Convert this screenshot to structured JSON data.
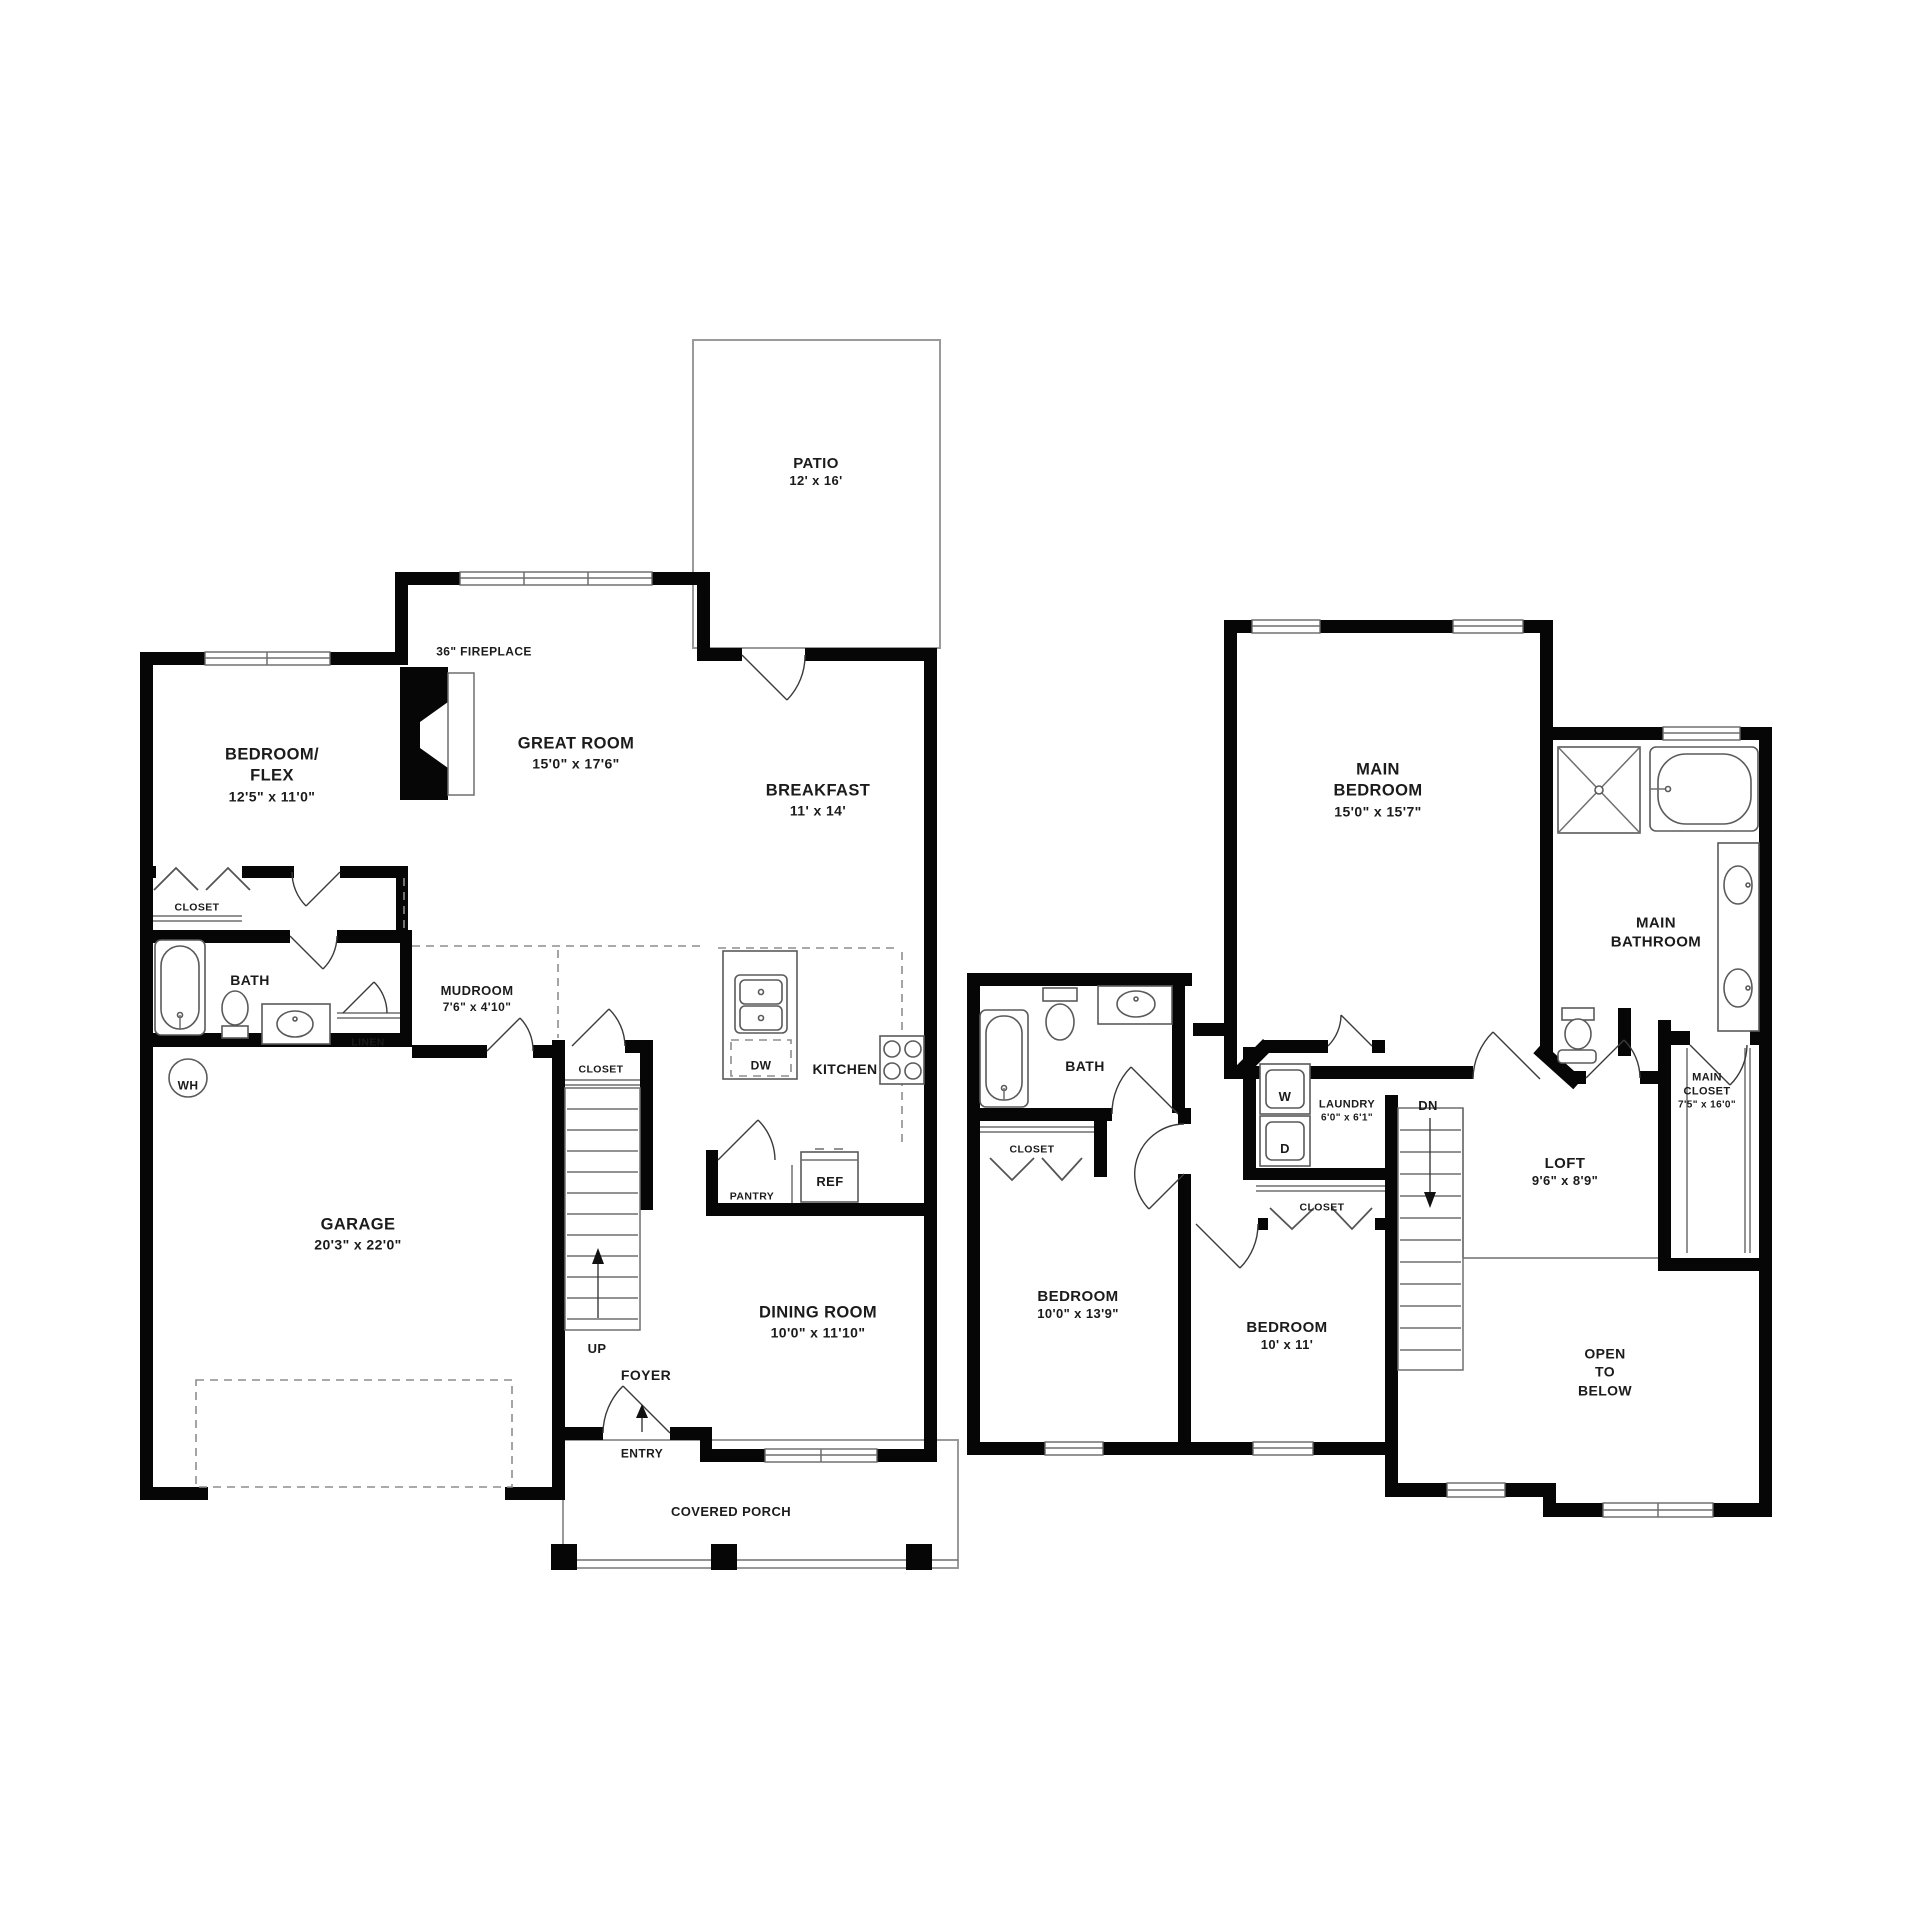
{
  "colors": {
    "wall": "#060606",
    "thin_line": "#6f6f6f",
    "text": "#1b1b1b",
    "background": "#ffffff"
  },
  "first_floor": {
    "patio": {
      "name": "PATIO",
      "dims": "12' x 16'"
    },
    "fireplace": {
      "label": "36\" FIREPLACE"
    },
    "great_room": {
      "name": "GREAT ROOM",
      "dims": "15'0\" x 17'6\""
    },
    "bedroom_flex": {
      "name": "BEDROOM/\nFLEX",
      "dims": "12'5\" x 11'0\""
    },
    "breakfast": {
      "name": "BREAKFAST",
      "dims": "11' x 14'"
    },
    "closet": {
      "label": "CLOSET"
    },
    "bath": {
      "label": "BATH"
    },
    "linen": {
      "label": "LINEN"
    },
    "mudroom": {
      "name": "MUDROOM",
      "dims": "7'6\" x 4'10\""
    },
    "water_heater": {
      "label": "WH"
    },
    "garage": {
      "name": "GARAGE",
      "dims": "20'3\" x 22'0\""
    },
    "stair_closet": {
      "label": "CLOSET"
    },
    "kitchen": {
      "label": "KITCHEN"
    },
    "dishwasher": {
      "label": "DW"
    },
    "refrigerator": {
      "label": "REF"
    },
    "pantry": {
      "label": "PANTRY"
    },
    "stairs": {
      "label": "UP"
    },
    "foyer": {
      "label": "FOYER"
    },
    "entry": {
      "label": "ENTRY",
      "arrow": "↑"
    },
    "dining_room": {
      "name": "DINING ROOM",
      "dims": "10'0\" x 11'10\""
    },
    "covered_porch": {
      "label": "COVERED PORCH"
    }
  },
  "second_floor": {
    "main_bedroom": {
      "name": "MAIN\nBEDROOM",
      "dims": "15'0\" x 15'7\""
    },
    "main_bathroom": {
      "name": "MAIN\nBATHROOM"
    },
    "main_closet": {
      "name": "MAIN\nCLOSET",
      "dims": "7'5\" x 16'0\""
    },
    "bath": {
      "label": "BATH"
    },
    "bath_closet": {
      "label": "CLOSET"
    },
    "laundry": {
      "name": "LAUNDRY",
      "dims": "6'0\" x 6'1\""
    },
    "washer": {
      "label": "W"
    },
    "dryer": {
      "label": "D"
    },
    "laundry_closet": {
      "label": "CLOSET"
    },
    "stairs": {
      "label": "DN"
    },
    "loft": {
      "name": "LOFT",
      "dims": "9'6\" x 8'9\""
    },
    "bedroom_1": {
      "name": "BEDROOM",
      "dims": "10'0\" x 13'9\""
    },
    "bedroom_2": {
      "name": "BEDROOM",
      "dims": "10' x 11'"
    },
    "open_to_below": {
      "name": "OPEN\nTO\nBELOW"
    }
  }
}
